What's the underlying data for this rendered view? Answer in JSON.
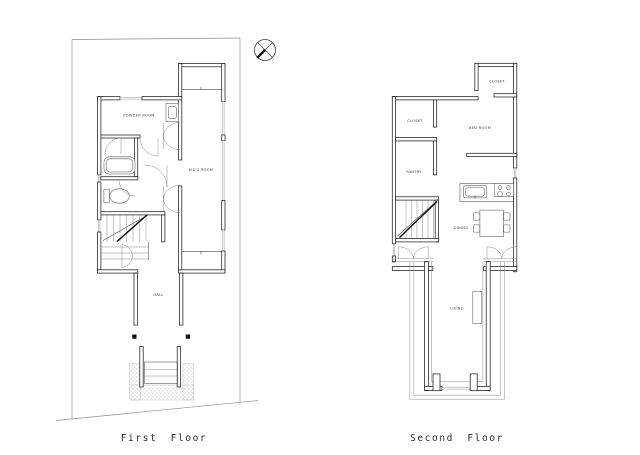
{
  "drawing": {
    "background": "#ffffff",
    "ink": "#1f1f1f",
    "captions": {
      "first": "First Floor",
      "second": "Second Floor"
    },
    "icons": {
      "north_arrow": "compass-circle-cross"
    },
    "first_floor": {
      "rooms": {
        "powder_room": "POWDER ROOM",
        "kids_room": "KID'S ROOM",
        "hall": "HALL"
      }
    },
    "second_floor": {
      "rooms": {
        "closet_upper": "CLOSET",
        "closet_left": "CLOSET",
        "pantry": "PANTRY",
        "bed_room": "BED ROOM",
        "dining": "DINING",
        "living": "LIVING"
      }
    }
  }
}
